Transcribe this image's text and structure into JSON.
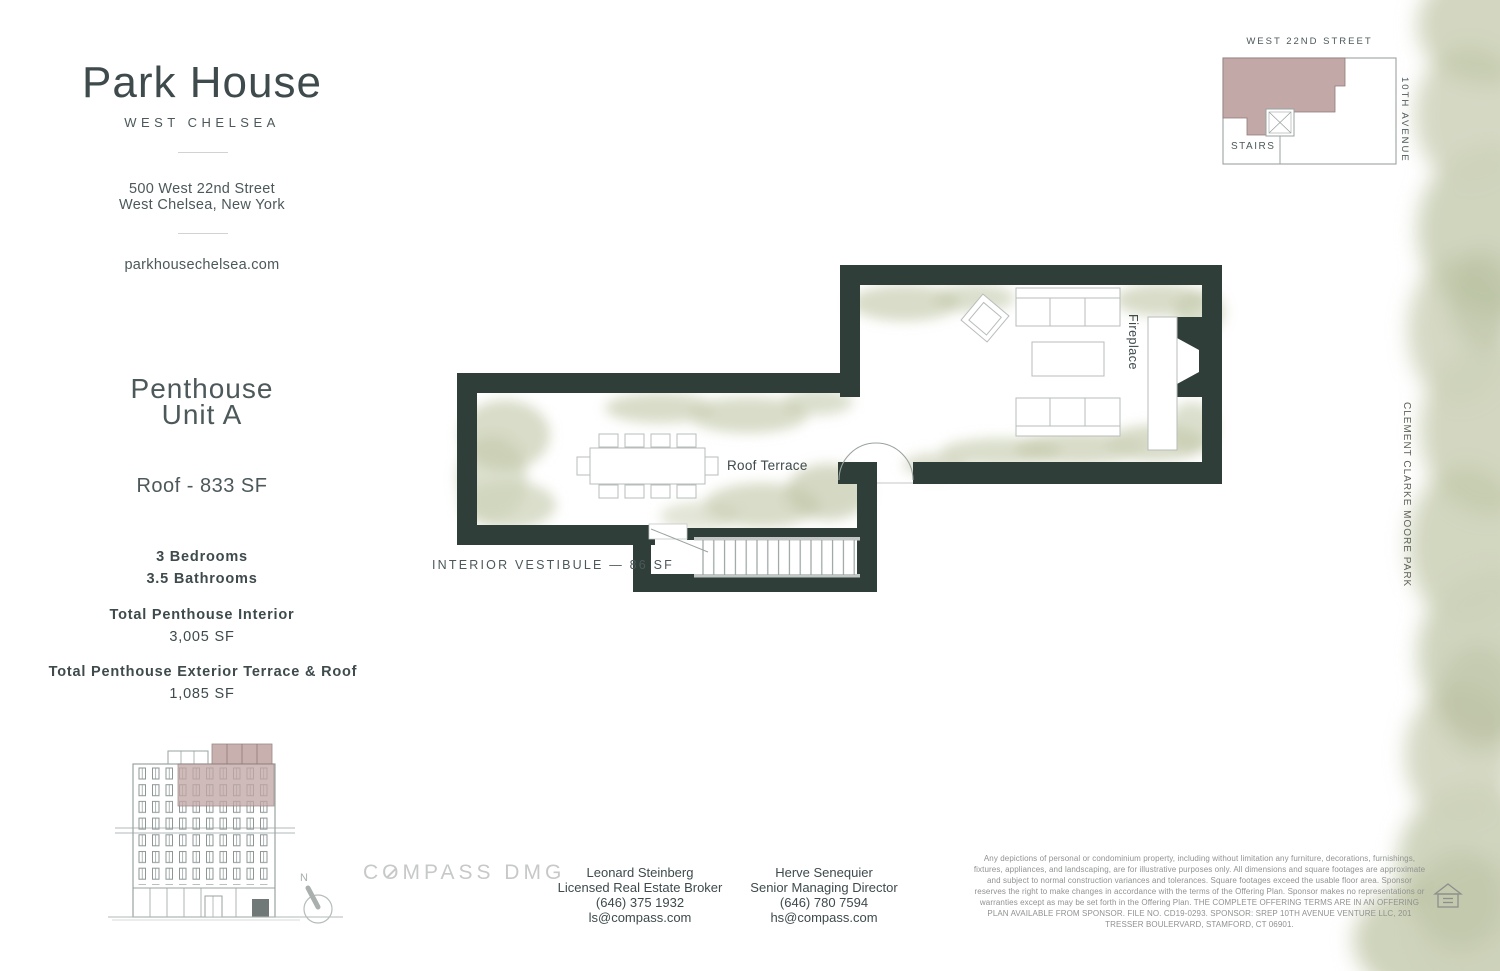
{
  "header": {
    "title": "Park House",
    "subtitle": "WEST CHELSEA",
    "address_line1": "500 West 22nd Street",
    "address_line2": "West Chelsea, New York",
    "website": "parkhousechelsea.com"
  },
  "unit": {
    "name_line1": "Penthouse",
    "name_line2": "Unit A",
    "floor_label": "Roof - 833 SF",
    "bedrooms": "3 Bedrooms",
    "bathrooms": "3.5 Bathrooms",
    "interior_label": "Total Penthouse Interior",
    "interior_sf": "3,005 SF",
    "exterior_label": "Total Penthouse Exterior Terrace & Roof",
    "exterior_sf": "1,085 SF"
  },
  "floor_plan": {
    "roof_terrace_label": "Roof Terrace",
    "fireplace_label": "Fireplace",
    "vestibule_label": "INTERIOR VESTIBULE — 86 SF"
  },
  "key_plan": {
    "street_top": "WEST 22ND STREET",
    "street_right": "10TH AVENUE",
    "stairs_label": "STAIRS"
  },
  "park_label": "CLEMENT CLARKE MOORE PARK",
  "compass": {
    "north_label": "N"
  },
  "footer": {
    "brokerage": "COMPASS DMG",
    "agents": [
      {
        "name": "Leonard Steinberg",
        "title": "Licensed Real Estate Broker",
        "phone": "(646) 375 1932",
        "email": "ls@compass.com"
      },
      {
        "name": "Herve Senequier",
        "title": "Senior Managing Director",
        "phone": "(646) 780 7594",
        "email": "hs@compass.com"
      }
    ],
    "disclaimer": "Any depictions of personal or condominium property, including without limitation any furniture, decorations, furnishings, fixtures, appliances, and landscaping, are for illustrative purposes only. All dimensions and square footages are approximate and subject to normal construction variances and tolerances.  Square footages exceed the usable floor area. Sponsor reserves the right to make changes in accordance with the terms of the Offering Plan. Sponsor makes no representations or warranties except as may be set forth in the Offering Plan. THE COMPLETE OFFERING TERMS ARE IN AN OFFERING PLAN AVAILABLE FROM SPONSOR.  FILE NO. CD19-0293.  SPONSOR: SREP 10TH AVENUE VENTURE LLC, 201 TRESSER BOULERVARD, STAMFORD, CT 06901."
  },
  "colors": {
    "wall": "#2f3e38",
    "mauve": "#c2a8a6",
    "mauve_deep": "#8f7a79",
    "green_light": "#ced3ba",
    "green_mid": "#c3c9ab",
    "green_dark": "#b4bc9c",
    "line_gray": "#9aa3a1",
    "furn_gray": "#b7bdbb",
    "text_dark": "#3e4a4c",
    "text_mid": "#4c585a",
    "text_light": "#8f938f",
    "logo_gray": "#c6c9c7"
  }
}
